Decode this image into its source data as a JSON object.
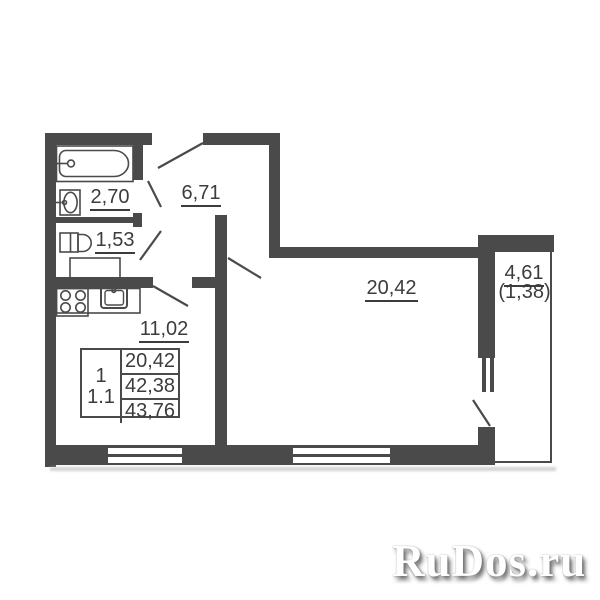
{
  "colors": {
    "wall": "#4a4a4a",
    "text": "#3c3c3c",
    "shadow": "#c6c6c6",
    "background": "#ffffff"
  },
  "rooms": {
    "bathroom": {
      "name": "bathroom",
      "area": "2,70"
    },
    "toilet": {
      "name": "toilet",
      "area": "1,53"
    },
    "hallway": {
      "name": "hallway",
      "area": "6,71"
    },
    "kitchen": {
      "name": "kitchen",
      "area": "11,02"
    },
    "living_room": {
      "name": "living-room",
      "area": "20,42"
    },
    "balcony": {
      "name": "balcony",
      "area": "4,61",
      "area_reduced": "(1,38)"
    }
  },
  "info_table": {
    "flat_type": "1",
    "unit": "1.1",
    "rows": [
      "20,42",
      "42,38",
      "43,76"
    ]
  },
  "watermark": {
    "text": "RuDos.ru"
  }
}
